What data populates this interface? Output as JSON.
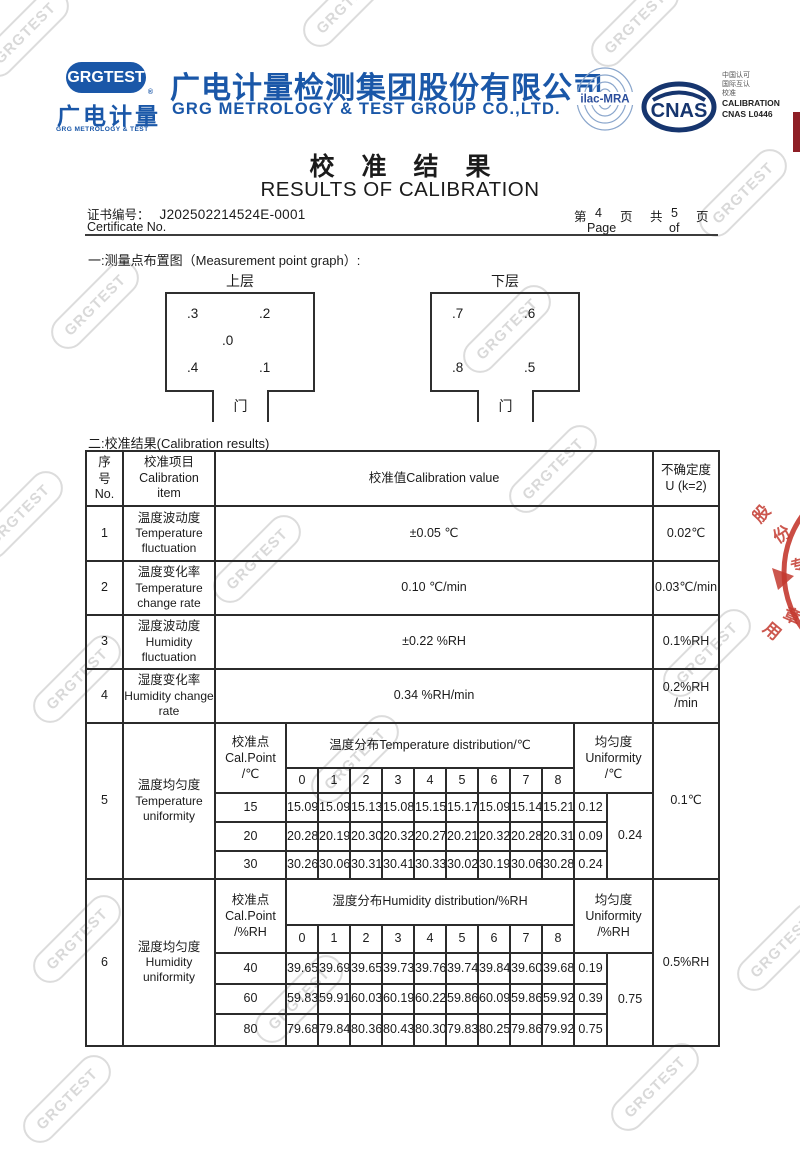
{
  "brand": {
    "badge": "GRGTEST",
    "reg_mark": "®",
    "logo_cn": "广电计量",
    "logo_en": "GRG METROLOGY & TEST",
    "company_cn": "广电计量检测集团股份有限公司",
    "company_en": "GRG METROLOGY & TEST GROUP CO.,LTD.",
    "blue": "#1a57a8"
  },
  "accreditation": {
    "ilac": "ilac-MRA",
    "cnas": "CNAS",
    "cn1": "中国认可",
    "cn2": "国际互认",
    "cn3": "校准",
    "en1": "CALIBRATION",
    "en2": "CNAS L0446"
  },
  "title": {
    "cn": "校准结果",
    "en": "RESULTS OF CALIBRATION"
  },
  "certificate": {
    "label_cn": "证书编号：",
    "number": "J202502214524E-0001",
    "label_en": "Certificate No.",
    "page_word1": "第",
    "page_no": "4",
    "page_word2": "页",
    "page_word3": "共",
    "page_total": "5",
    "page_word4": "页",
    "page_en": "Page",
    "of_en": "of"
  },
  "section1": {
    "heading": "一:测量点布置图（Measurement point graph）:",
    "upper": {
      "label": "上层",
      "door": "门",
      "points": [
        ".3",
        ".2",
        ".0",
        ".4",
        ".1"
      ]
    },
    "lower": {
      "label": "下层",
      "door": "门",
      "points": [
        ".7",
        ".6",
        ".8",
        ".5"
      ]
    }
  },
  "section2": {
    "heading": "二:校准结果(Calibration results)"
  },
  "table": {
    "header": {
      "no_cn": "序号",
      "no_en": "No.",
      "item_cn": "校准项目",
      "item_en1": "Calibration",
      "item_en2": "item",
      "value": "校准值Calibration value",
      "unc_cn": "不确定度",
      "unc_en": "U (k=2)"
    },
    "rows": [
      {
        "no": "1",
        "item_cn": "温度波动度",
        "item_en": "Temperature fluctuation",
        "value": "±0.05 ℃",
        "uncertainty": "0.02℃"
      },
      {
        "no": "2",
        "item_cn": "温度变化率",
        "item_en": "Temperature change rate",
        "value": "0.10 ℃/min",
        "uncertainty": "0.03℃/min"
      },
      {
        "no": "3",
        "item_cn": "湿度波动度",
        "item_en": "Humidity fluctuation",
        "value": "±0.22 %RH",
        "uncertainty": "0.1%RH"
      },
      {
        "no": "4",
        "item_cn": "湿度变化率",
        "item_en": "Humidity change rate",
        "value": "0.34 %RH/min",
        "uncertainty": "0.2%RH\n/min"
      }
    ],
    "uniformity_blocks": [
      {
        "no": "5",
        "item_cn": "温度均匀度",
        "item_en": "Temperature uniformity",
        "cal_cn": "校准点",
        "cal_en": "Cal.Point",
        "cal_unit": "/℃",
        "dist_label": "温度分布Temperature distribution/℃",
        "point_cols": [
          "0",
          "1",
          "2",
          "3",
          "4",
          "5",
          "6",
          "7",
          "8"
        ],
        "uni_cn": "均匀度",
        "uni_en": "Uniformity",
        "uni_unit": "/℃",
        "rows": [
          {
            "point": "15",
            "values": [
              "15.09",
              "15.09",
              "15.13",
              "15.08",
              "15.15",
              "15.17",
              "15.09",
              "15.14",
              "15.21"
            ],
            "row_uniformity": "0.12"
          },
          {
            "point": "20",
            "values": [
              "20.28",
              "20.19",
              "20.30",
              "20.32",
              "20.27",
              "20.21",
              "20.32",
              "20.28",
              "20.31"
            ],
            "row_uniformity": "0.09"
          },
          {
            "point": "30",
            "values": [
              "30.26",
              "30.06",
              "30.31",
              "30.41",
              "30.33",
              "30.02",
              "30.19",
              "30.06",
              "30.28"
            ],
            "row_uniformity": "0.24"
          }
        ],
        "overall_uniformity": "0.24",
        "uncertainty": "0.1℃"
      },
      {
        "no": "6",
        "item_cn": "湿度均匀度",
        "item_en": "Humidity uniformity",
        "cal_cn": "校准点",
        "cal_en": "Cal.Point",
        "cal_unit": "/%RH",
        "dist_label": "湿度分布Humidity distribution/%RH",
        "point_cols": [
          "0",
          "1",
          "2",
          "3",
          "4",
          "5",
          "6",
          "7",
          "8"
        ],
        "uni_cn": "均匀度",
        "uni_en": "Uniformity",
        "uni_unit": "/%RH",
        "rows": [
          {
            "point": "40",
            "values": [
              "39.65",
              "39.69",
              "39.65",
              "39.73",
              "39.76",
              "39.74",
              "39.84",
              "39.60",
              "39.68"
            ],
            "row_uniformity": "0.19"
          },
          {
            "point": "60",
            "values": [
              "59.83",
              "59.91",
              "60.03",
              "60.19",
              "60.22",
              "59.86",
              "60.09",
              "59.86",
              "59.92"
            ],
            "row_uniformity": "0.39"
          },
          {
            "point": "80",
            "values": [
              "79.68",
              "79.84",
              "80.36",
              "80.43",
              "80.30",
              "79.83",
              "80.25",
              "79.86",
              "79.92"
            ],
            "row_uniformity": "0.75"
          }
        ],
        "overall_uniformity": "0.75",
        "uncertainty": "0.5%RH"
      }
    ]
  },
  "watermark": {
    "text": "GRGTEST"
  },
  "stamp": {
    "char1": "股",
    "char2": "份",
    "char3": "专",
    "char4": "用",
    "char5": "章",
    "color": "#c43a30"
  }
}
